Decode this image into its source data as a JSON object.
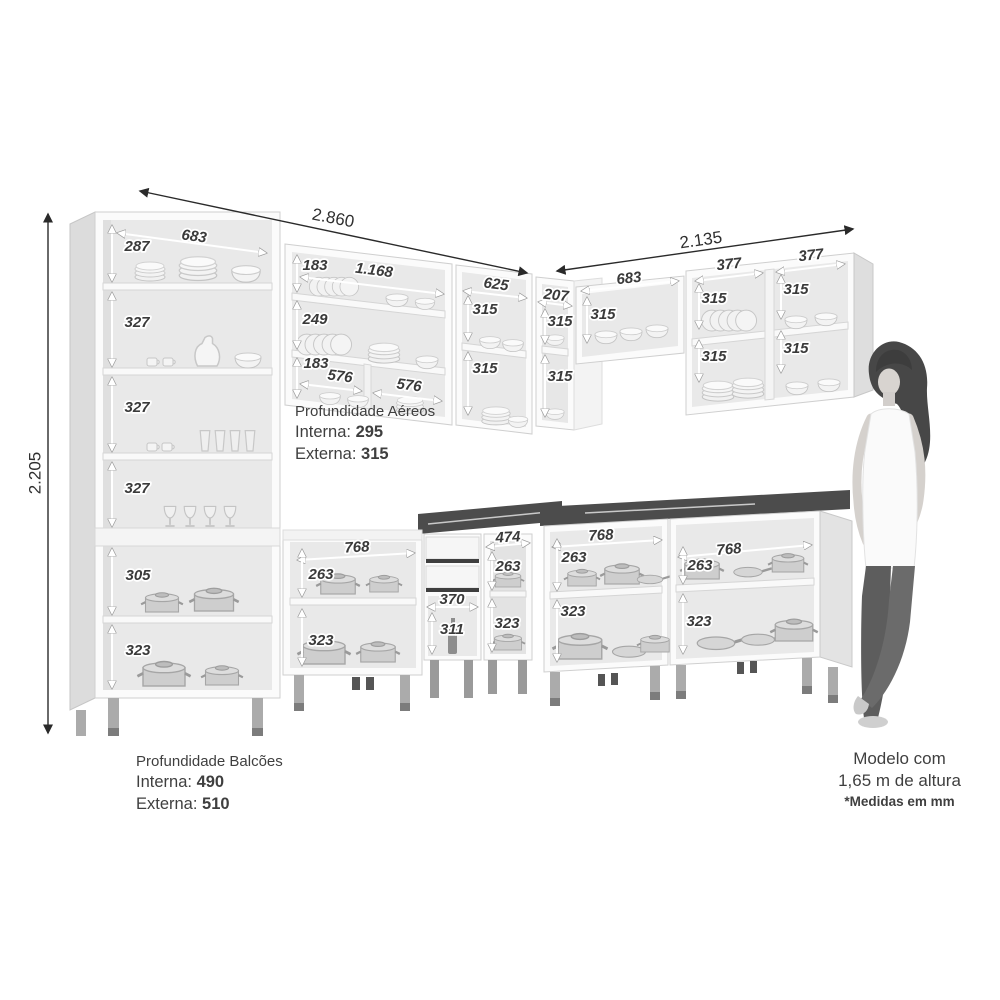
{
  "overall": {
    "width_left_mm": "2.860",
    "width_right_mm": "2.135",
    "height_mm": "2.205"
  },
  "dims": {
    "tall": {
      "width": "683",
      "c1": "287",
      "c2": "327",
      "c3": "327",
      "c4": "327",
      "c5": "305",
      "c6": "323"
    },
    "wall_a": {
      "width": "1.168",
      "r1": "183",
      "r2": "249",
      "r3": "183",
      "sub1": "576",
      "sub2": "576"
    },
    "wall_b": {
      "width": "625",
      "r1": "315",
      "r2": "315"
    },
    "wall_corner": {
      "width": "207",
      "r1": "315",
      "r2": "315"
    },
    "wall_bridge": {
      "width": "683",
      "h": "315"
    },
    "wall_right": {
      "w1": "377",
      "w2": "377",
      "c1r1": "315",
      "c1r2": "315",
      "c2r1": "315",
      "c2r2": "315"
    },
    "base_mid": {
      "width": "768",
      "r1": "263",
      "r2": "323"
    },
    "drawer_unit": {
      "width": "370",
      "h": "311"
    },
    "base_corner": {
      "width": "474",
      "r1": "263",
      "r2": "323"
    },
    "base_r1": {
      "width": "768",
      "r1": "263",
      "r2": "323"
    },
    "base_r2": {
      "width": "768",
      "r1": "263",
      "r2": "323"
    }
  },
  "notes": {
    "aereos": {
      "title": "Profundidade Aéreos",
      "interna_label": "Interna:",
      "interna_value": "295",
      "externa_label": "Externa:",
      "externa_value": "315"
    },
    "balcoes": {
      "title": "Profundidade Balcões",
      "interna_label": "Interna:",
      "interna_value": "490",
      "externa_label": "Externa:",
      "externa_value": "510"
    },
    "modelo": {
      "line1": "Modelo com",
      "line2": "1,65 m de altura",
      "line3": "*Medidas em mm"
    }
  },
  "colors": {
    "countertop": "#4c4c4c",
    "dim_label": "#3a3a3a",
    "outer_arrow": "#2a2a2a",
    "cabinet_interior": "#e9e9e9"
  }
}
